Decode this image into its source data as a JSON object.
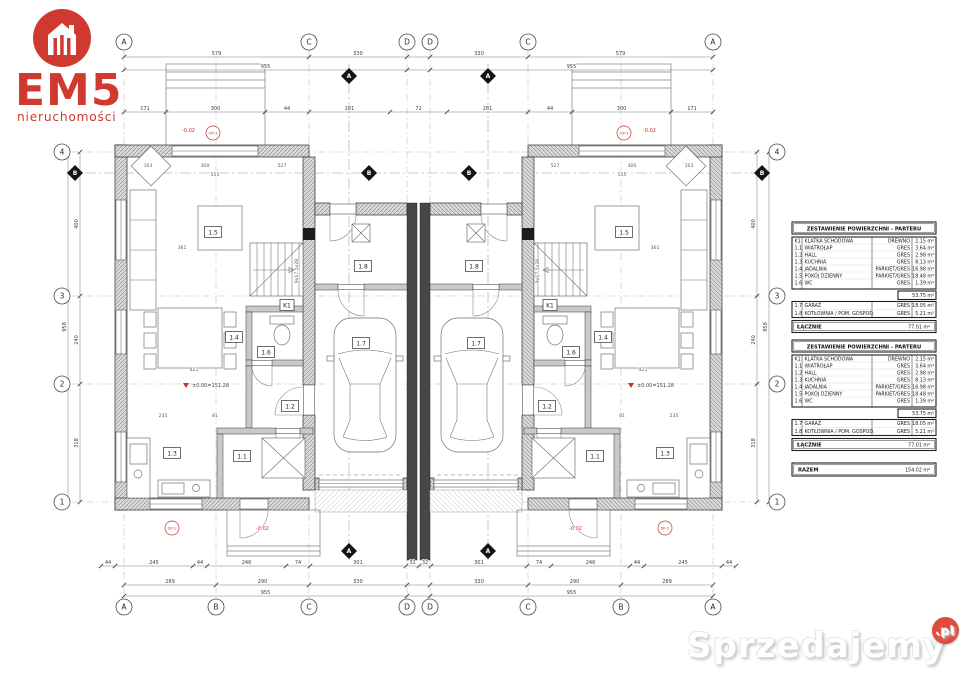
{
  "logo": {
    "brand": "EM5",
    "tagline": "nieruchomości",
    "accent": "#d0392f"
  },
  "watermark": {
    "name": "Sprzedajemy",
    "tld": ".pl"
  },
  "plan": {
    "grid": {
      "top": [
        "A",
        "C",
        "D",
        "D",
        "C",
        "A"
      ],
      "bottom": [
        "A",
        "B",
        "C",
        "D",
        "D",
        "C",
        "B",
        "A"
      ],
      "left": [
        "4",
        "3",
        "2",
        "1"
      ],
      "right": [
        "4",
        "3",
        "2",
        "1"
      ],
      "section_vertical": "A",
      "section_horizontal": "B"
    },
    "room_labels": [
      "1.5",
      "1.8",
      "K1",
      "1.6",
      "1.4",
      "1.7",
      "1.2",
      "1.3",
      "1.1"
    ],
    "notes": {
      "level": "±0.00=151.28",
      "below_grade": "-0.02",
      "stair_spec": "9x17,5x28",
      "marker_terrace": "OP-3",
      "marker_entry": "SP-1"
    },
    "dims": {
      "top_main": [
        "579",
        "330",
        "330",
        "579"
      ],
      "top_totals": [
        "955",
        "955"
      ],
      "top_inner": [
        "171",
        "300",
        "44",
        "281",
        "72",
        "281",
        "44",
        "300",
        "171"
      ],
      "bottom_micro": [
        "44",
        "245",
        "44",
        "246",
        "74",
        "301",
        "32",
        "32",
        "301",
        "74",
        "246",
        "44",
        "245",
        "44"
      ],
      "bottom_main": [
        "289",
        "290",
        "330",
        "330",
        "290",
        "289"
      ],
      "bottom_totals": [
        "955",
        "955"
      ],
      "side_segments": [
        "400",
        "240",
        "318"
      ],
      "side_totals": [
        "958"
      ],
      "inner": [
        "103",
        "300",
        "527",
        "555",
        "361",
        "421",
        "235",
        "81"
      ]
    }
  },
  "tables": [
    {
      "title": "ZESTAWIENIE POWIERZCHNI - PARTERU",
      "rows": [
        {
          "id": "K1",
          "name": "KLATKA SCHODOWA",
          "finish": "DREWNO",
          "area": "2.15 m²"
        },
        {
          "id": "1.1",
          "name": "WIATROŁAP",
          "finish": "GRES",
          "area": "3.64 m²"
        },
        {
          "id": "1.2",
          "name": "HALL",
          "finish": "GRES",
          "area": "2.98 m²"
        },
        {
          "id": "1.3",
          "name": "KUCHNIA",
          "finish": "GRES",
          "area": "8.13 m²"
        },
        {
          "id": "1.4",
          "name": "JADALNIA",
          "finish": "PARKIET/GRES",
          "area": "16.98 m²"
        },
        {
          "id": "1.5",
          "name": "POKÓJ DZIENNY",
          "finish": "PARKIET/GRES",
          "area": "18.48 m²"
        },
        {
          "id": "1.6",
          "name": "WC",
          "finish": "GRES",
          "area": "1.39 m²"
        }
      ],
      "subtotal": "53.75 m²",
      "rows2": [
        {
          "id": "1.7",
          "name": "GARAŻ",
          "finish": "GRES",
          "area": "18.05 m²"
        },
        {
          "id": "1.8",
          "name": "KOTŁOWNIA / POM. GOSPOD.",
          "finish": "GRES",
          "area": "5.21 m²"
        }
      ],
      "total_label": "ŁĄCZNIE",
      "total": "77.01 m²"
    },
    {
      "title": "ZESTAWIENIE POWIERZCHNI - PARTERU",
      "rows": [
        {
          "id": "K1",
          "name": "KLATKA SCHODOWA",
          "finish": "DREWNO",
          "area": "2.15 m²"
        },
        {
          "id": "1.1",
          "name": "WIATROŁAP",
          "finish": "GRES",
          "area": "3.64 m²"
        },
        {
          "id": "1.2",
          "name": "HALL",
          "finish": "GRES",
          "area": "2.98 m²"
        },
        {
          "id": "1.3",
          "name": "KUCHNIA",
          "finish": "GRES",
          "area": "8.13 m²"
        },
        {
          "id": "1.4",
          "name": "JADALNIA",
          "finish": "PARKIET/GRES",
          "area": "16.98 m²"
        },
        {
          "id": "1.5",
          "name": "POKÓJ DZIENNY",
          "finish": "PARKIET/GRES",
          "area": "18.48 m²"
        },
        {
          "id": "1.6",
          "name": "WC",
          "finish": "GRES",
          "area": "1.39 m²"
        }
      ],
      "subtotal": "53.75 m²",
      "rows2": [
        {
          "id": "1.7",
          "name": "GARAŻ",
          "finish": "GRES",
          "area": "18.05 m²"
        },
        {
          "id": "1.8",
          "name": "KOTŁOWNIA / POM. GOSPOD.",
          "finish": "GRES",
          "area": "5.21 m²"
        }
      ],
      "total_label": "ŁĄCZNIE",
      "total": "77.01 m²"
    }
  ],
  "summary": {
    "label": "RAZEM",
    "value": "154.02 m²"
  }
}
